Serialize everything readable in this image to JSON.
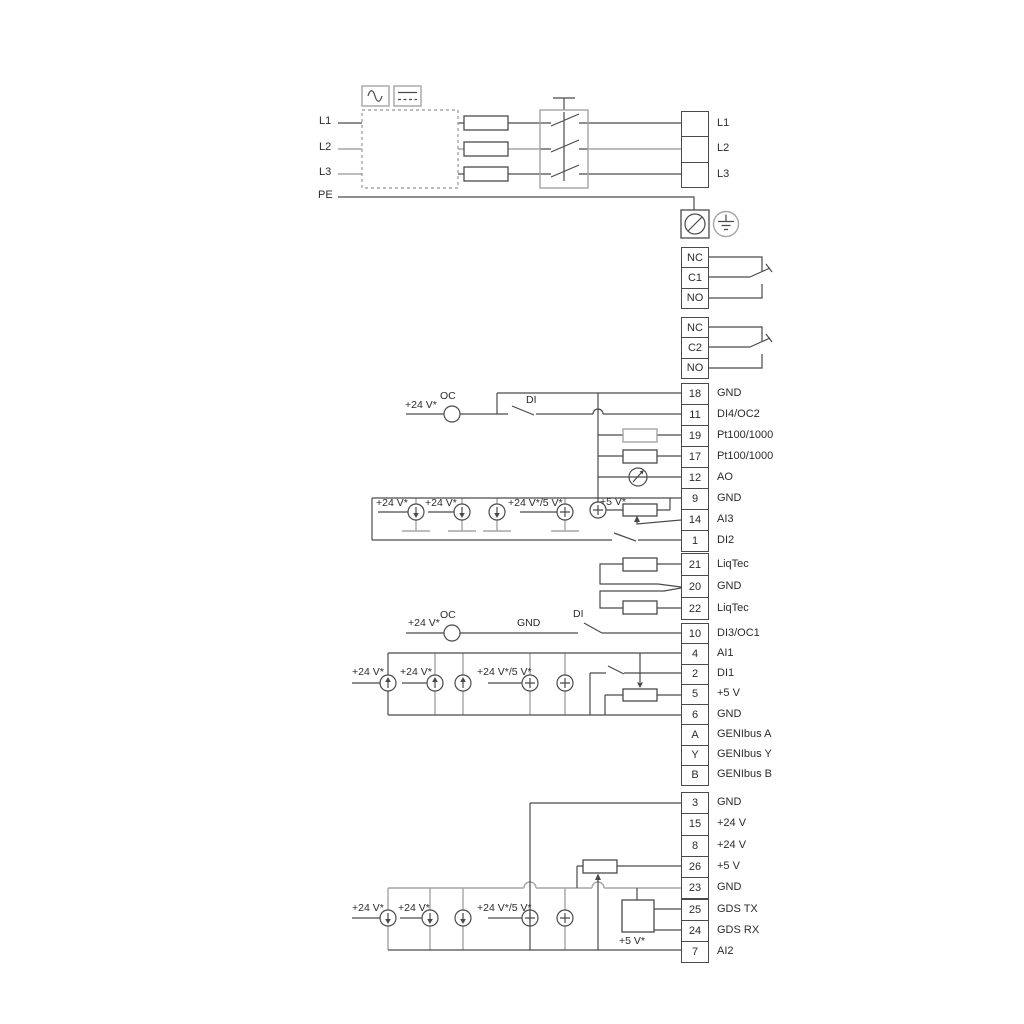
{
  "diagram_title": "Pump drive wiring diagram",
  "colors": {
    "background": "#ffffff",
    "wire_dark": "#4a4a4a",
    "wire_gray": "#a6a6a6",
    "text": "#2b2b2b"
  },
  "icons": {
    "ac-symbol": "sine-wave",
    "dc-symbol": "solid-over-dashed-line",
    "rfi-filter": "dashed-box",
    "fuse": "rectangle-on-wire",
    "breaker-switch": "three-pole-switch",
    "pe-terminal": "circle-with-slash",
    "earth-ground": "circle-with-earth-bars",
    "resistor": "rectangle-on-wire",
    "analog-meter": "circle-with-needle",
    "potentiometer": "rectangle-with-wiper-arrow",
    "current-source-down": "circle-with-down-arrow",
    "current-source-up": "circle-with-up-arrow",
    "supply-source": "circle-with-plus",
    "open-collector": "plain-circle"
  },
  "left_labels": [
    {
      "t": "L1"
    },
    {
      "t": "L2"
    },
    {
      "t": "L3"
    },
    {
      "t": "PE"
    }
  ],
  "strips": [
    {
      "id": "power",
      "rows": [
        {
          "n": "",
          "label": "L1"
        },
        {
          "n": "",
          "label": "L2"
        },
        {
          "n": "",
          "label": "L3"
        }
      ]
    },
    {
      "id": "relay1",
      "rows": [
        {
          "n": "NC",
          "label": ""
        },
        {
          "n": "C1",
          "label": ""
        },
        {
          "n": "NO",
          "label": ""
        }
      ]
    },
    {
      "id": "relay2",
      "rows": [
        {
          "n": "NC",
          "label": ""
        },
        {
          "n": "C2",
          "label": ""
        },
        {
          "n": "NO",
          "label": ""
        }
      ]
    },
    {
      "id": "io_a",
      "rows": [
        {
          "n": "18",
          "label": "GND"
        },
        {
          "n": "11",
          "label": "DI4/OC2"
        },
        {
          "n": "19",
          "label": "Pt100/1000"
        },
        {
          "n": "17",
          "label": "Pt100/1000"
        },
        {
          "n": "12",
          "label": "AO"
        },
        {
          "n": "9",
          "label": "GND"
        },
        {
          "n": "14",
          "label": "AI3"
        },
        {
          "n": "1",
          "label": "DI2"
        }
      ]
    },
    {
      "id": "liqtec",
      "rows": [
        {
          "n": "21",
          "label": "LiqTec"
        },
        {
          "n": "20",
          "label": "GND"
        },
        {
          "n": "22",
          "label": "LiqTec"
        }
      ]
    },
    {
      "id": "io_b",
      "rows": [
        {
          "n": "10",
          "label": "DI3/OC1"
        },
        {
          "n": "4",
          "label": "AI1"
        },
        {
          "n": "2",
          "label": "DI1"
        },
        {
          "n": "5",
          "label": "+5 V"
        },
        {
          "n": "6",
          "label": "GND"
        },
        {
          "n": "A",
          "label": "GENIbus A"
        },
        {
          "n": "Y",
          "label": "GENIbus Y"
        },
        {
          "n": "B",
          "label": "GENIbus B"
        }
      ]
    },
    {
      "id": "io_c",
      "rows": [
        {
          "n": "3",
          "label": "GND"
        },
        {
          "n": "15",
          "label": "+24 V"
        },
        {
          "n": "8",
          "label": "+24 V"
        },
        {
          "n": "26",
          "label": "+5 V"
        },
        {
          "n": "23",
          "label": "GND"
        },
        {
          "n": "25",
          "label": "GDS TX"
        },
        {
          "n": "24",
          "label": "GDS RX"
        },
        {
          "n": "7",
          "label": "AI2"
        }
      ]
    }
  ],
  "wire_labels": [
    {
      "t": "+24 V*"
    },
    {
      "t": "OC"
    },
    {
      "t": "DI"
    },
    {
      "t": "+24 V*"
    },
    {
      "t": "+24 V*"
    },
    {
      "t": "+24 V*/5 V*"
    },
    {
      "t": "+5 V*"
    },
    {
      "t": "+24 V*"
    },
    {
      "t": "OC"
    },
    {
      "t": "GND"
    },
    {
      "t": "DI"
    },
    {
      "t": "+24 V*"
    },
    {
      "t": "+24 V*"
    },
    {
      "t": "+24 V*/5 V*"
    },
    {
      "t": "+24 V*"
    },
    {
      "t": "+24 V*"
    },
    {
      "t": "+24 V*/5 V*"
    },
    {
      "t": "+5 V*"
    }
  ]
}
